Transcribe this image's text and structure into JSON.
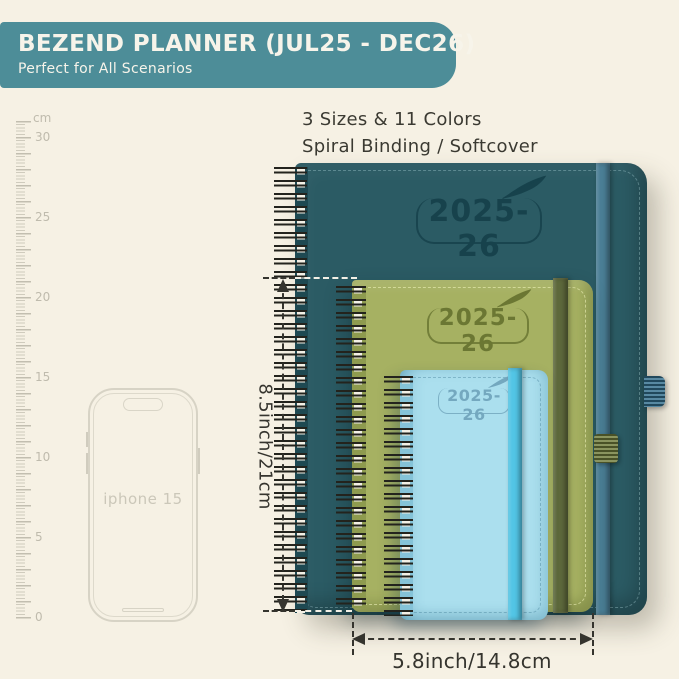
{
  "header": {
    "title": "BEZEND PLANNER (JUL25 - DEC26)",
    "subtitle": "Perfect for All Scenarios"
  },
  "intro": {
    "line1": "3 Sizes & 11 Colors",
    "line2": "Spiral Binding / Softcover"
  },
  "ruler": {
    "unit": "cm",
    "labels": [
      "30",
      "25",
      "20",
      "15",
      "10",
      "5",
      "0"
    ]
  },
  "phone": {
    "label": "iphone 15"
  },
  "planners": {
    "large": {
      "year": "2025-26",
      "cover_color": "#2b5b64",
      "emboss_color": "#17424c",
      "band_color": "#4a7e95",
      "logo_icon": "feather-quill"
    },
    "medium": {
      "year": "2025-26",
      "cover_color": "#a6b162",
      "emboss_color": "#6b7733",
      "band_color": "#5d683b",
      "logo_icon": "feather-quill"
    },
    "small": {
      "year": "2025-26",
      "cover_color": "#abdfee",
      "emboss_color": "#74a8bf",
      "band_color": "#52c5e5",
      "logo_icon": "feather-quill"
    }
  },
  "dimensions": {
    "height_label": "8.5inch/21cm",
    "width_label": "5.8inch/14.8cm"
  },
  "colors": {
    "background": "#f6f1e4",
    "banner": "#4d8d98",
    "banner_text": "#f7f4ea",
    "annotation": "#35342e",
    "ruler": "#c6c2b4"
  }
}
